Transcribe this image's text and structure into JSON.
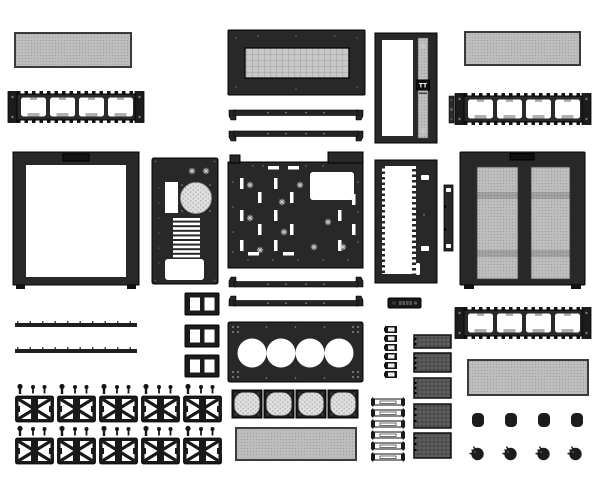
{
  "diagram": {
    "title": "PC case exploded parts diagram",
    "brand_logo": "TT",
    "background": "#ffffff",
    "palette": {
      "background": "#ffffff",
      "part-dark": "#282828",
      "part-black": "#191919",
      "mesh-light": "#bdbdbd",
      "mesh-grid": "#c8c8c8",
      "mesh-hex": "#e0e0e0",
      "mesh-dark": "#606060",
      "cutout-white": "#ffffff",
      "outline": "#000000"
    },
    "parts": [
      {
        "id": "dust-filter-panel",
        "label": "Magnetic mesh dust filter",
        "qty": 4
      },
      {
        "id": "fan-bracket-frame",
        "label": "Fan / radiator bracket frame",
        "qty": 3
      },
      {
        "id": "glass-side-panel",
        "label": "Tempered glass side panel",
        "qty": 1
      },
      {
        "id": "mesh-side-panel",
        "label": "Vented mesh side panel",
        "qty": 1
      },
      {
        "id": "top-panel",
        "label": "Top panel with vent",
        "qty": 1
      },
      {
        "id": "front-panel",
        "label": "Front panel with logo strip",
        "qty": 1
      },
      {
        "id": "front-frame",
        "label": "Front frame with window",
        "qty": 1
      },
      {
        "id": "rear-panel",
        "label": "Rear panel (I/O, PCI slots, PSU)",
        "qty": 1
      },
      {
        "id": "motherboard-tray",
        "label": "Motherboard tray",
        "qty": 1
      },
      {
        "id": "fan-mounting-plate",
        "label": "Quad-fan mounting plate",
        "qty": 1
      },
      {
        "id": "square-fan-filter",
        "label": "Square fan filter",
        "qty": 4
      },
      {
        "id": "support-rail",
        "label": "Support rail",
        "qty": 4
      },
      {
        "id": "flat-strip",
        "label": "Flat trim strip",
        "qty": 2
      },
      {
        "id": "two-hole-bracket",
        "label": "Two-hole bracket",
        "qty": 3
      },
      {
        "id": "clip-unit-with-screws",
        "label": "Mounting clip with screws",
        "qty": 10
      },
      {
        "id": "io-port-bar",
        "label": "Front I/O port bar",
        "qty": 1
      },
      {
        "id": "small-clip",
        "label": "Small retention clip",
        "qty": 6
      },
      {
        "id": "slide-rail",
        "label": "Slide rail",
        "qty": 6
      },
      {
        "id": "mesh-tray-cover",
        "label": "Mesh drive-tray cover",
        "qty": 5
      },
      {
        "id": "side-strip",
        "label": "Narrow side strip",
        "qty": 2
      },
      {
        "id": "rubber-foot",
        "label": "Rubber foot",
        "qty": 4
      },
      {
        "id": "thumbscrew",
        "label": "Thumbscrew",
        "qty": 4
      }
    ]
  }
}
